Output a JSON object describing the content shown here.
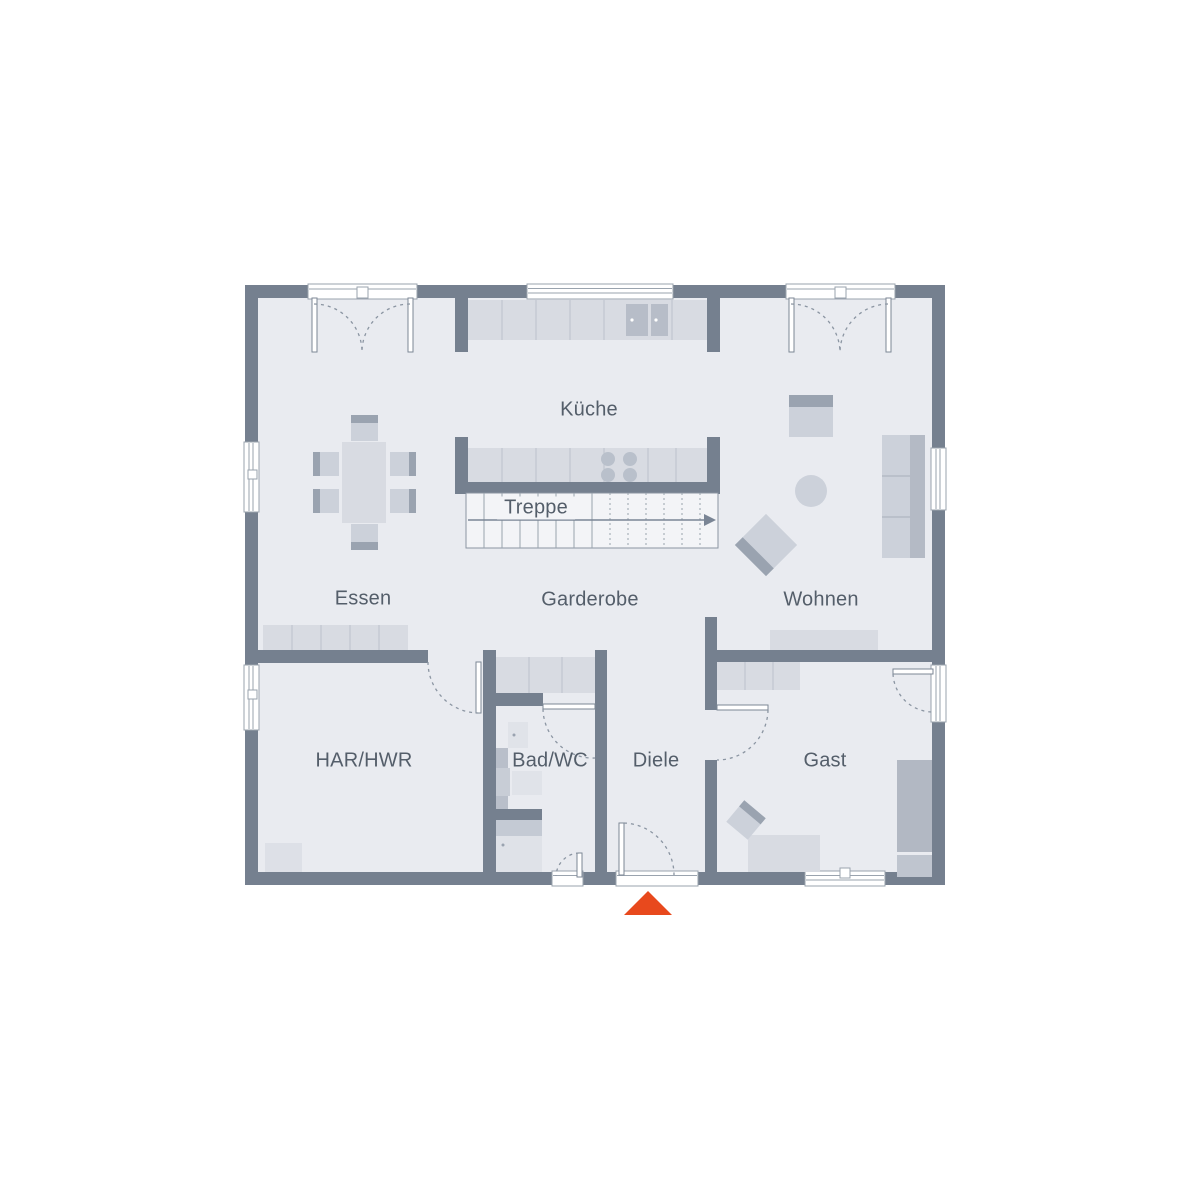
{
  "floorplan": {
    "rooms": [
      {
        "id": "kueche",
        "label": "Küche"
      },
      {
        "id": "essen",
        "label": "Essen"
      },
      {
        "id": "garderobe",
        "label": "Garderobe"
      },
      {
        "id": "wohnen",
        "label": "Wohnen"
      },
      {
        "id": "har-hwr",
        "label": "HAR/HWR"
      },
      {
        "id": "bad-wc",
        "label": "Bad/WC"
      },
      {
        "id": "diele",
        "label": "Diele"
      },
      {
        "id": "gast",
        "label": "Gast"
      },
      {
        "id": "treppe",
        "label": "Treppe"
      }
    ],
    "colors": {
      "wall": "#75808f",
      "floor": "#e9ebf0",
      "furniture_light": "#d8dbe2",
      "furniture_mid": "#ccd1da",
      "furniture_dark": "#9aa3b0",
      "stair_field": "#f3f4f7",
      "entrance_marker": "#e8491d",
      "label_text": "#545e6a"
    },
    "icons": {
      "entrance_marker": "triangle-up-icon",
      "stair_direction": "arrow-right-icon"
    }
  }
}
